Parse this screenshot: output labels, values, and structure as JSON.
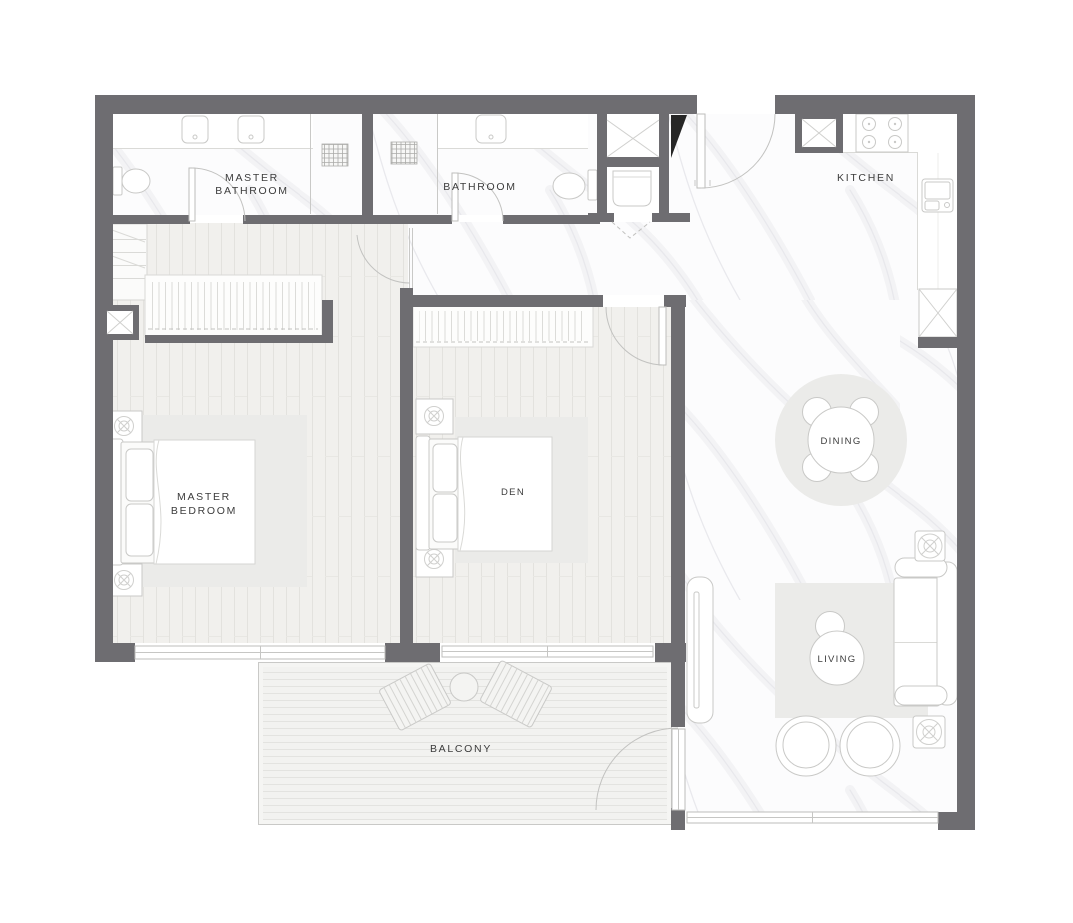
{
  "plan": {
    "rooms": {
      "master_bathroom": {
        "lines": [
          "MASTER",
          "BATHROOM"
        ]
      },
      "bathroom": {
        "label": "BATHROOM"
      },
      "kitchen": {
        "label": "KITCHEN"
      },
      "master_bedroom": {
        "lines": [
          "MASTER",
          "BEDROOM"
        ]
      },
      "den": {
        "label": "DEN"
      },
      "dining": {
        "label": "DINING"
      },
      "living": {
        "label": "LIVING"
      },
      "balcony": {
        "label": "BALCONY"
      }
    },
    "colors": {
      "wall": "#6e6d71",
      "wallDark": "#262626",
      "wood": "#f1f0ed",
      "marble": "#fcfcfd",
      "deck": "#f2f2f0",
      "rug": "#ebebe9",
      "outline": "#c9c9c7",
      "label": "#3c3c3c",
      "background": "#ffffff"
    }
  }
}
